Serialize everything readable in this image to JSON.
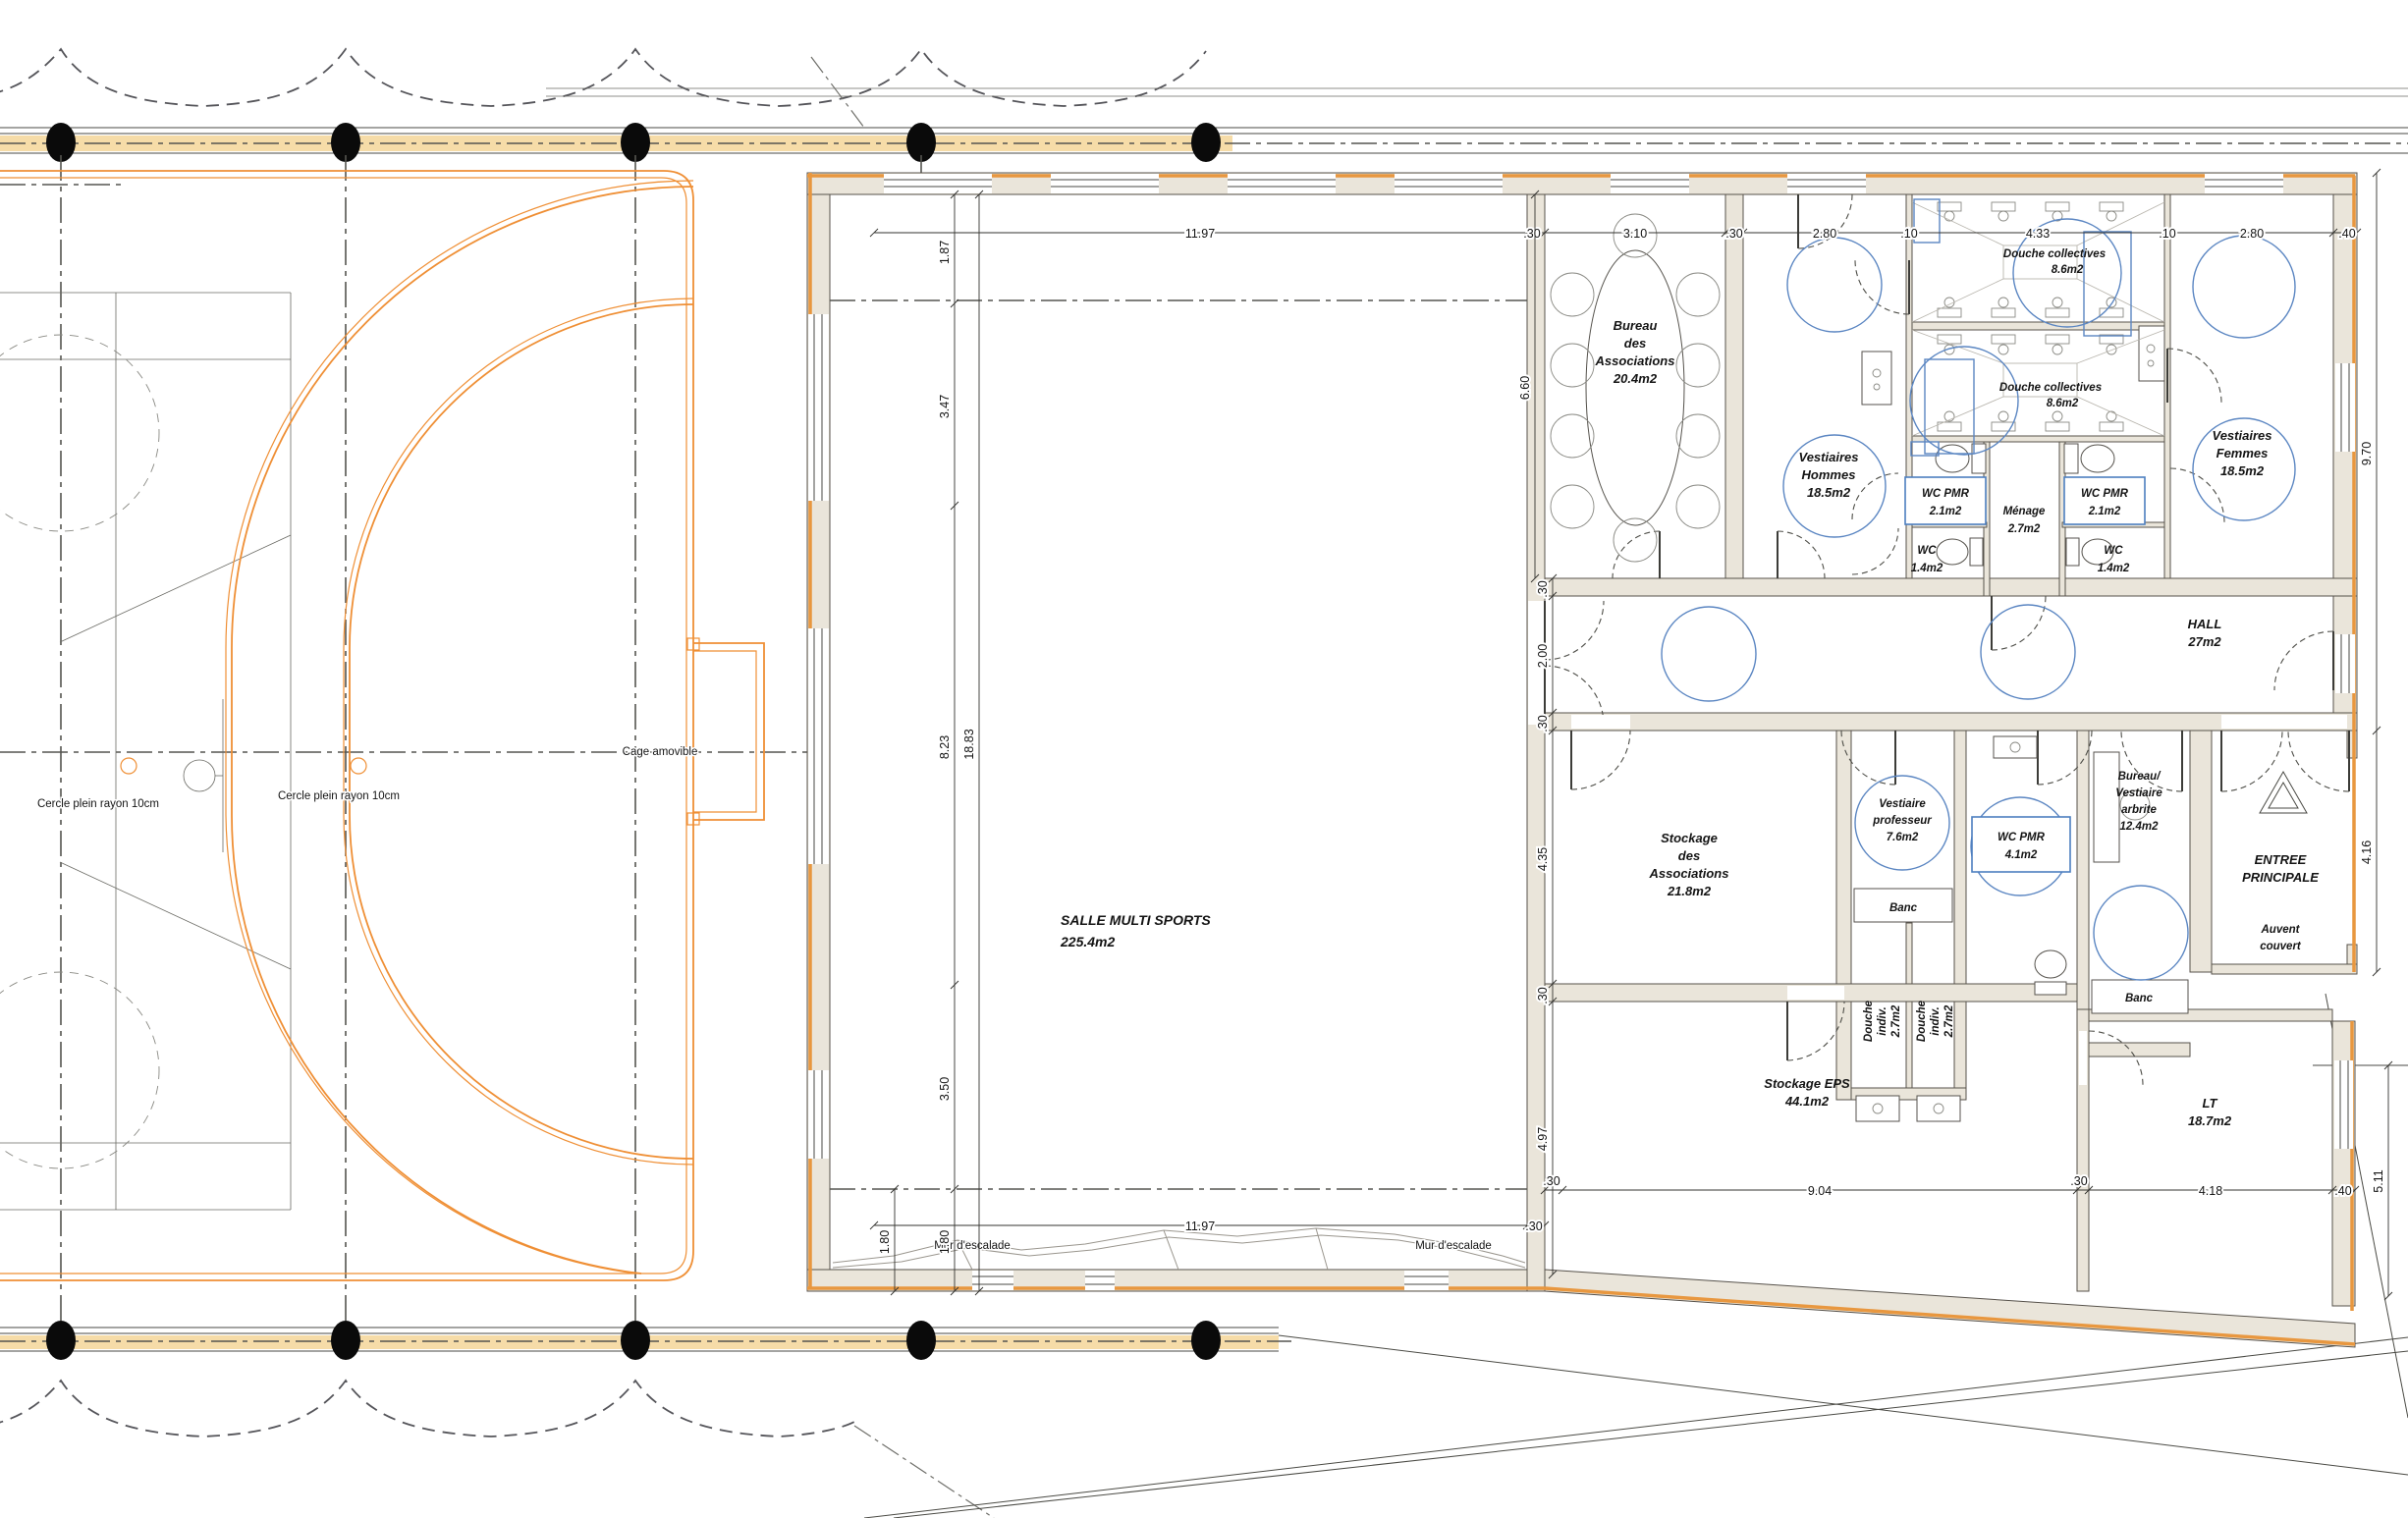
{
  "title": "Floor plan - salle multisports",
  "colors": {
    "wall_fill": "#eae5da",
    "cladding_orange": "#e8973f",
    "court_orange": "#ef8f35",
    "fixture_blue": "#5b86c2",
    "site_band_fill": "#f6dca8",
    "line": "#4a4a44"
  },
  "labels": {
    "salle1": "SALLE MULTI SPORTS",
    "salle2": "225.4m2",
    "bureau1": "Bureau",
    "bureau2": "des",
    "bureau3": "Associations",
    "bureau4": "20.4m2",
    "vhommes1": "Vestiaires",
    "vhommes2": "Hommes",
    "vhommes3": "18.5m2",
    "douche1a": "Douche collectives",
    "douche1b": "8.6m2",
    "douche2a": "Douche collectives",
    "douche2b": "8.6m2",
    "vfemmes1": "Vestiaires",
    "vfemmes2": "Femmes",
    "vfemmes3": "18.5m2",
    "wcpmrL1": "WC PMR",
    "wcpmrL2": "2.1m2",
    "wcpmrR1": "WC PMR",
    "wcpmrR2": "2.1m2",
    "menage1": "Ménage",
    "menage2": "2.7m2",
    "wcL1": "WC",
    "wcL2": "1.4m2",
    "wcR1": "WC",
    "wcR2": "1.4m2",
    "hall1": "HALL",
    "hall2": "27m2",
    "stockassoc1": "Stockage",
    "stockassoc2": "des",
    "stockassoc3": "Associations",
    "stockassoc4": "21.8m2",
    "vprof1": "Vestiaire",
    "vprof2": "professeur",
    "vprof3": "7.6m2",
    "wcpmr21": "WC PMR",
    "wcpmr22": "4.1m2",
    "banc1": "Banc",
    "banc2": "Banc",
    "dind1a": "Douche",
    "dind1b": "indiv.",
    "dind1c": "2.7m2",
    "dind2a": "Douche",
    "dind2b": "indiv.",
    "dind2c": "2.7m2",
    "arbitre1": "Bureau/",
    "arbitre2": "Vestiaire",
    "arbitre3": "arbrite",
    "arbitre4": "12.4m2",
    "entree1": "ENTREE",
    "entree2": "PRINCIPALE",
    "auvent1": "Auvent",
    "auvent2": "couvert",
    "eps1": "Stockage EPS",
    "eps2": "44.1m2",
    "lt1": "LT",
    "lt2": "18.7m2",
    "murL": "Mur d'escalade",
    "murR": "Mur d'escalade",
    "cercle1": "Cercle plein rayon 10cm",
    "cercle2": "Cercle plein rayon 10cm",
    "cage": "Cage amovible"
  },
  "dims": {
    "t1": "11.97",
    "t2": ".30",
    "t3": "3.10",
    "t4": ".30",
    "t5": "2.80",
    "t6": ".10",
    "t7": "4.33",
    "t8": ".10",
    "t9": "2.80",
    "t10": ".40",
    "l1": "1.87",
    "l2": "3.47",
    "l3": "8.23",
    "l4": "3.50",
    "l5": "1.80",
    "l6": "18.83",
    "r1": "9.70",
    "r2": "4.16",
    "r3": "5.11",
    "m1": ".30",
    "m2": "2.00",
    "m3": ".30",
    "m4": "6.60",
    "m5": "4.35",
    "m6": ".30",
    "m7": "4.97",
    "b1": "11.97",
    "b2": ".30",
    "b3": "1.80",
    "b4": ".30",
    "b5": "9.04",
    "b6": ".30",
    "b7": "4.18",
    "b8": ".40"
  }
}
